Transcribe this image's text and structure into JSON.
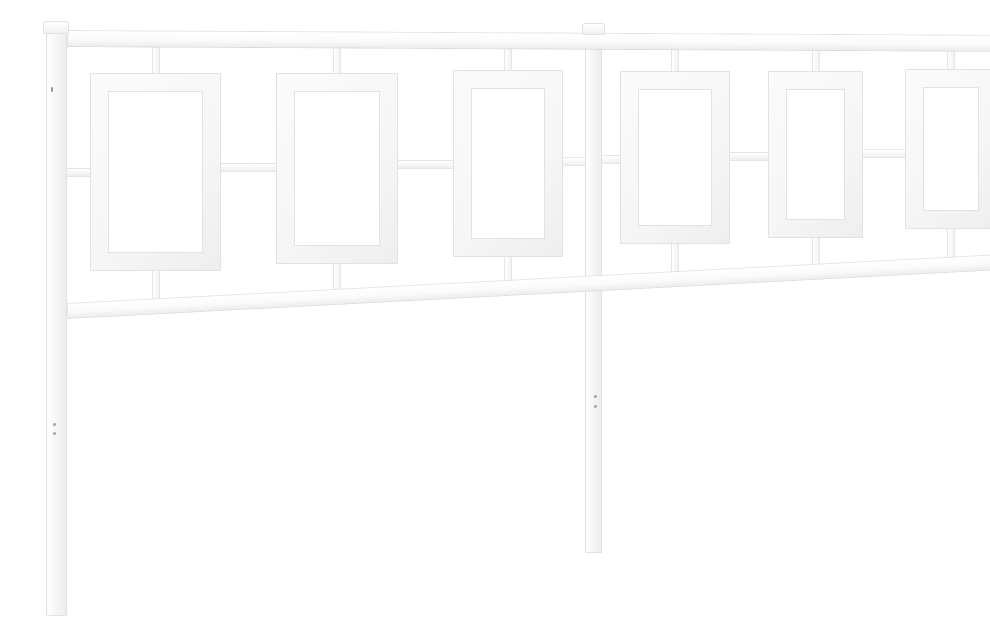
{
  "photo": {
    "subject": "White metal headboard on a white background",
    "description": "Product photograph of a white steel headboard shot at a slight angle. Three vertical square posts with small caps (left, center, right) support a straight top rail and a lower rail. Between the rails hang two symmetric sections, each with three open rectangular frame panels joined to the rails by short stubs and linked at mid-height by short horizontal connectors. Each post has a pair of tiny screw holes on its lower leg.",
    "object": {
      "type": "headboard",
      "material": "metal",
      "finish": "white",
      "legs": 3,
      "sections": 2,
      "frames_per_section": 3,
      "frame_shape": "rectangle",
      "top_stubs": 6,
      "bottom_stubs": 6,
      "mid_connectors": 8,
      "screw_hole_pairs": 3
    },
    "colors": {
      "background": "#ffffff",
      "metal": "#fbfbfb",
      "metal_shade": "#ededed",
      "outline": "#e2e2e2",
      "screw": "#a8a8a8",
      "speck": "#9a9a9a"
    }
  }
}
